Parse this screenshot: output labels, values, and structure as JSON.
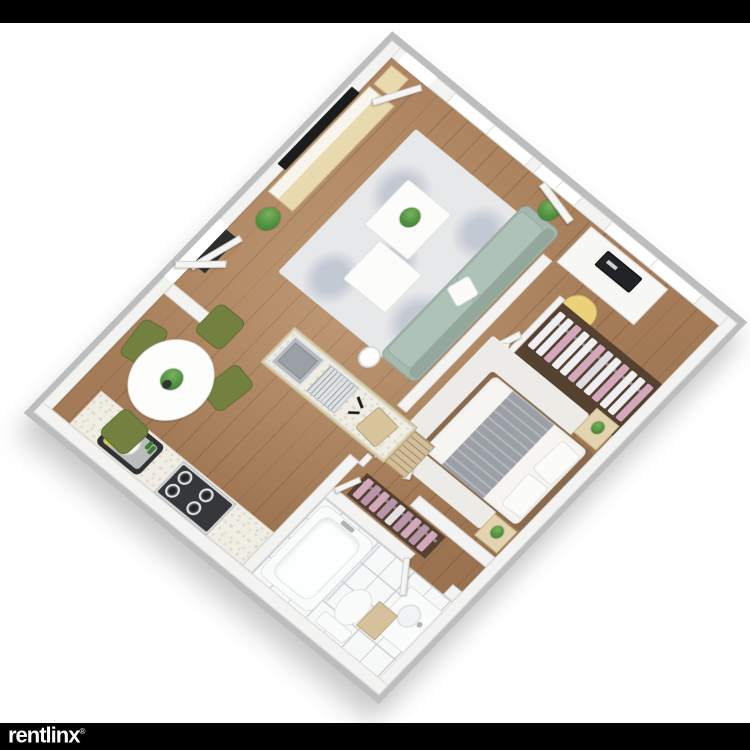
{
  "watermark": {
    "logo_text": "rentlinx",
    "registered_mark": "®"
  },
  "floor_plan": {
    "view": "3d-isometric-apartment-floor-plan",
    "rooms": [
      "living-room",
      "bedroom",
      "kitchen",
      "dining-nook",
      "bathroom",
      "hallway",
      "entry"
    ],
    "inventory": {
      "living_room": [
        "wall-tv",
        "tv-console",
        "area-rug",
        "coffee-tables",
        "sofa",
        "throw-pillow",
        "floor-lamp-table",
        "potted-plants",
        "windows"
      ],
      "bedroom": [
        "desk",
        "computer-monitor",
        "yellow-chair",
        "window",
        "wardrobe-with-hanging-clothes",
        "double-bed",
        "gray-blanket",
        "pillows",
        "nightstands",
        "bedside-plants",
        "area-rug"
      ],
      "kitchen": [
        "island-with-sink",
        "dish-rack",
        "cutting-board",
        "wall-counter",
        "square-sink",
        "gas-stove"
      ],
      "dining_nook": [
        "round-table",
        "table-plant",
        "four-olive-chairs"
      ],
      "bathroom": [
        "bathtub",
        "toilet",
        "vanity-sink",
        "tan-cabinet",
        "glass-partition",
        "tiled-floor"
      ],
      "hallway": [
        "closet-with-pink-clothes",
        "doors"
      ],
      "entry": [
        "double-entry-doors",
        "dark-vestibule",
        "plant",
        "side-table"
      ]
    }
  },
  "colors": {
    "bar": "#000000",
    "page_bg": "#ffffff",
    "logo_white": "#ffffff",
    "wall_top": "#f3f3f1",
    "wall_face": "#bcbdbe",
    "wood": "#a97c55",
    "rug_living": "#e7e8ea",
    "rug_mottle": "#c3c9d3",
    "rug_bed": "#edebe7",
    "sofa": "#a6b9b0",
    "sofa_dark": "#93a79d",
    "table_white": "#fcfcfb",
    "console_wood": "#e9d9af",
    "island_wood": "#d9ccab",
    "counter": "#efede4",
    "stainless": "#b6bbbf",
    "stove_dark": "#35373a",
    "chair_olive": "#72813f",
    "chair_yellow": "#ecd17b",
    "bed_linen": "#f6f5f2",
    "blanket": "#9ba0a6",
    "bed_frame": "#8a6a4e",
    "closet_floor": "#54412f",
    "clothes_pink": "#d3a8ba",
    "clothes_white": "#f0eff1",
    "tile": "#f7f8f8",
    "tile_line": "#ccd0d2",
    "fixture_white": "#fafbfb",
    "cabinet_tan": "#d7c09c",
    "door": "#f5f5f3",
    "plant": "#4f9040",
    "plant_dark": "#3a7a2e",
    "pot": "#333333",
    "tv": "#1b1c1e",
    "glass": "#ccd5da",
    "sink_rim": "#2f3134",
    "sponge_yellow": "#e5c72f",
    "bottle_green": "#3f7d37",
    "shadow": "rgba(0,0,0,0.22)"
  }
}
